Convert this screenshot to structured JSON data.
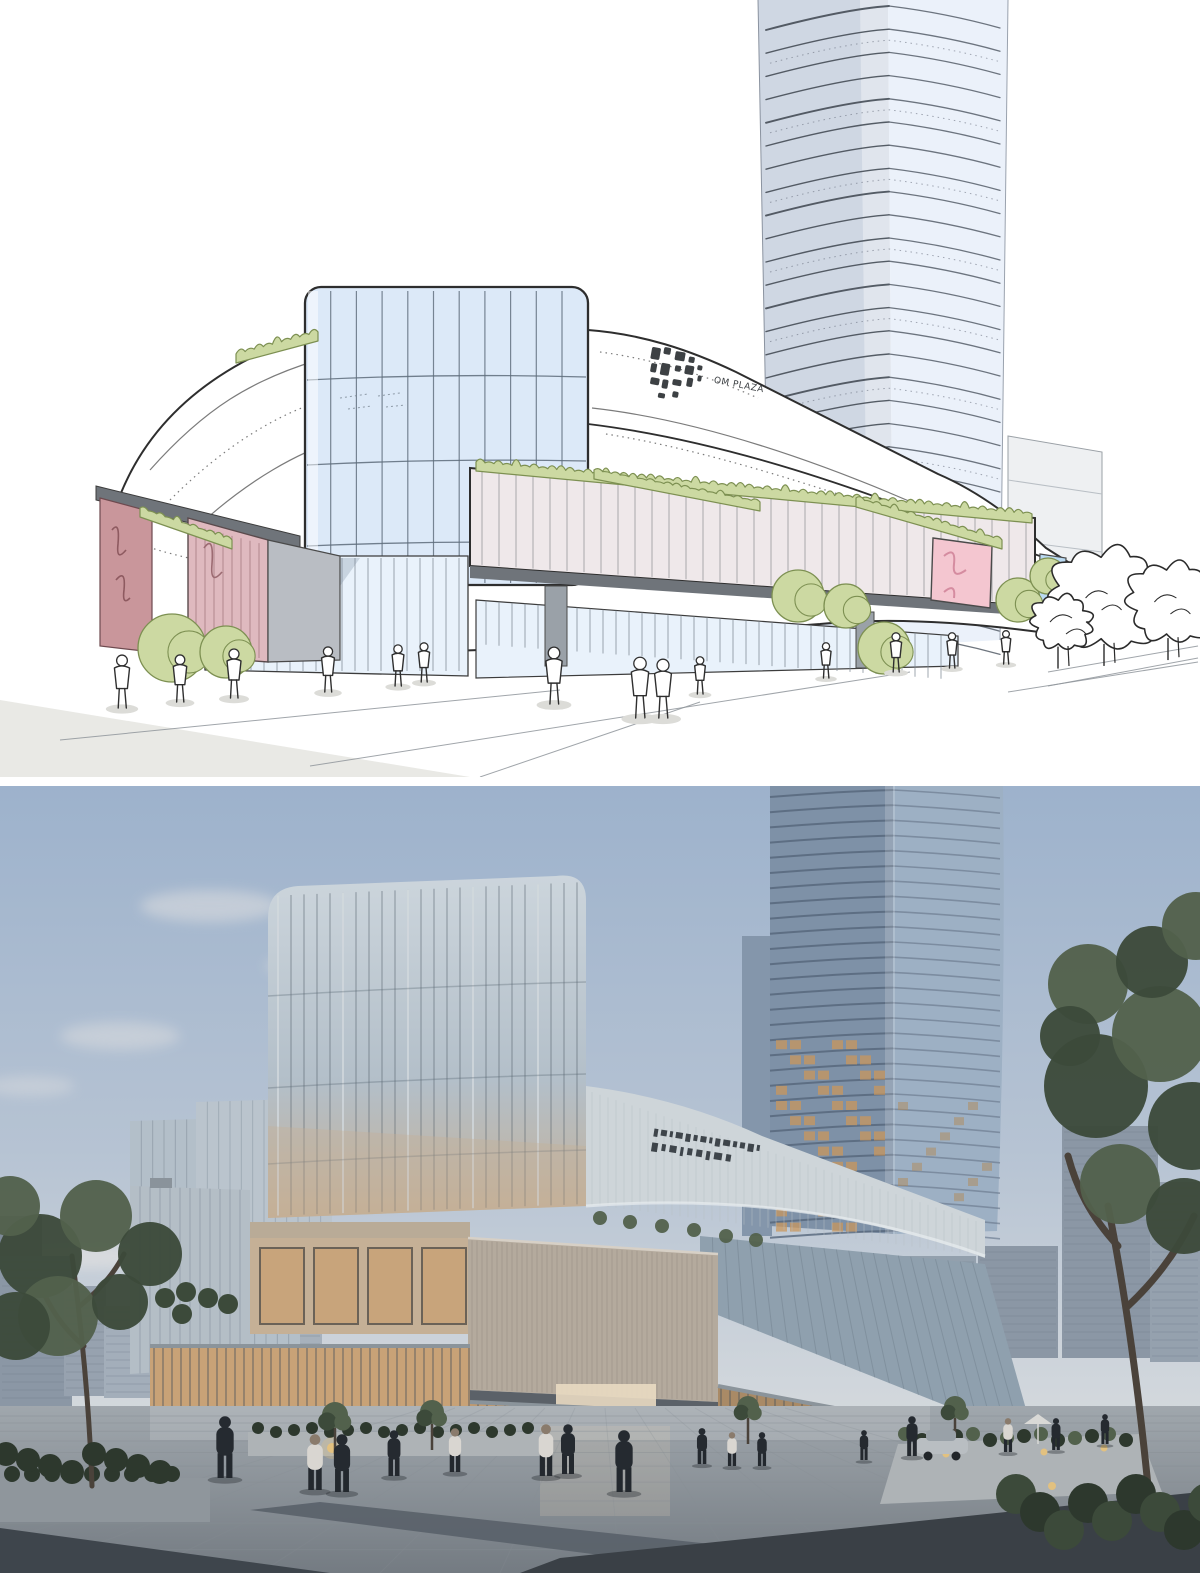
{
  "page": {
    "type": "architectural visualization, two stacked panels: concept sketch above, photoreal dusk render below",
    "signage_text": "OM PLAZA"
  },
  "panels": {
    "sketch": {
      "label": "hand-drawn concept sketch of mixed-use complex",
      "signage": {
        "logo": "pixel-cluster logo",
        "text": "OM PLAZA"
      },
      "elements": [
        "high-rise tower",
        "curved white podium bands",
        "glass cube atrium",
        "ribbed front volume",
        "roof hedges",
        "pink LED screen",
        "mauve accent panels",
        "outline trees",
        "pedestrians"
      ],
      "pedestrian_count": 14
    },
    "render": {
      "label": "photorealistic dusk render of same complex",
      "signage": {
        "text_legible": false,
        "lines": 2
      },
      "elements": [
        "glass tower with lit floors",
        "glass cube atrium",
        "channel-glass volume",
        "stone plaza",
        "planters with hedges",
        "street trees",
        "distant city blocks",
        "pedestrians",
        "car",
        "umbrella"
      ],
      "pedestrian_count": 16
    }
  },
  "palette": {
    "sketch": {
      "outline": "#2e2e2e",
      "paper": "#ffffff",
      "glass": "#dce9f8",
      "glass_line": "#5d6b7a",
      "shade": "#e8e7e2",
      "ground": "#e9e9e5",
      "gray_block": "#b9bdc3",
      "dark_gray": "#6f747a",
      "green": "#ccd9a2",
      "green_line": "#7d9052",
      "pink_screen": "#f4c6d0",
      "pink_rib": "#dfb9bf",
      "mauve": "#c9969b",
      "blue_panel": "#badaf2",
      "tower_left": "#cfd7e3",
      "tower_right": "#ebf1fa",
      "figure": "#2f2f2f",
      "shadow": "#dcdcd8",
      "ribbed": "#efe8ea",
      "glass_ground": "#e9f2fb"
    },
    "render": {
      "sky_top": "#9db2cc",
      "sky_mid": "#b6c3d3",
      "sky_horizon": "#d7dbde",
      "cloud": "#e9e6e3",
      "tower_left": "#7e91a7",
      "tower_right": "#9db0c4",
      "tower_band": "#55657a",
      "lit_window": "#c9975c",
      "glass_cool": "#b3bfc9",
      "glass_cool_dark": "#8fa0ae",
      "glass_warm": "#c5b096",
      "fascia": "#ced5d9",
      "rib_metal": "#b4aa9d",
      "mullion": "#46525d",
      "interior": "#c8a277",
      "door_glow": "#e9dac2",
      "plaza": "#a0a7ad",
      "plaza_dark": "#3e454c",
      "stripe": "#596169",
      "planter": "#aeb3b6",
      "hedge": "#2d382d",
      "tree_dark": "#3c4a3a",
      "tree_mid": "#52614c",
      "trunk": "#4a423a",
      "distant": "#8b97a5",
      "distant_light": "#a3aeba",
      "people": "#252a30",
      "people_light": "#d9d6d1",
      "car": "#b9bec2",
      "light_warm": "#e8c27a",
      "signage": "#2f353b"
    }
  }
}
